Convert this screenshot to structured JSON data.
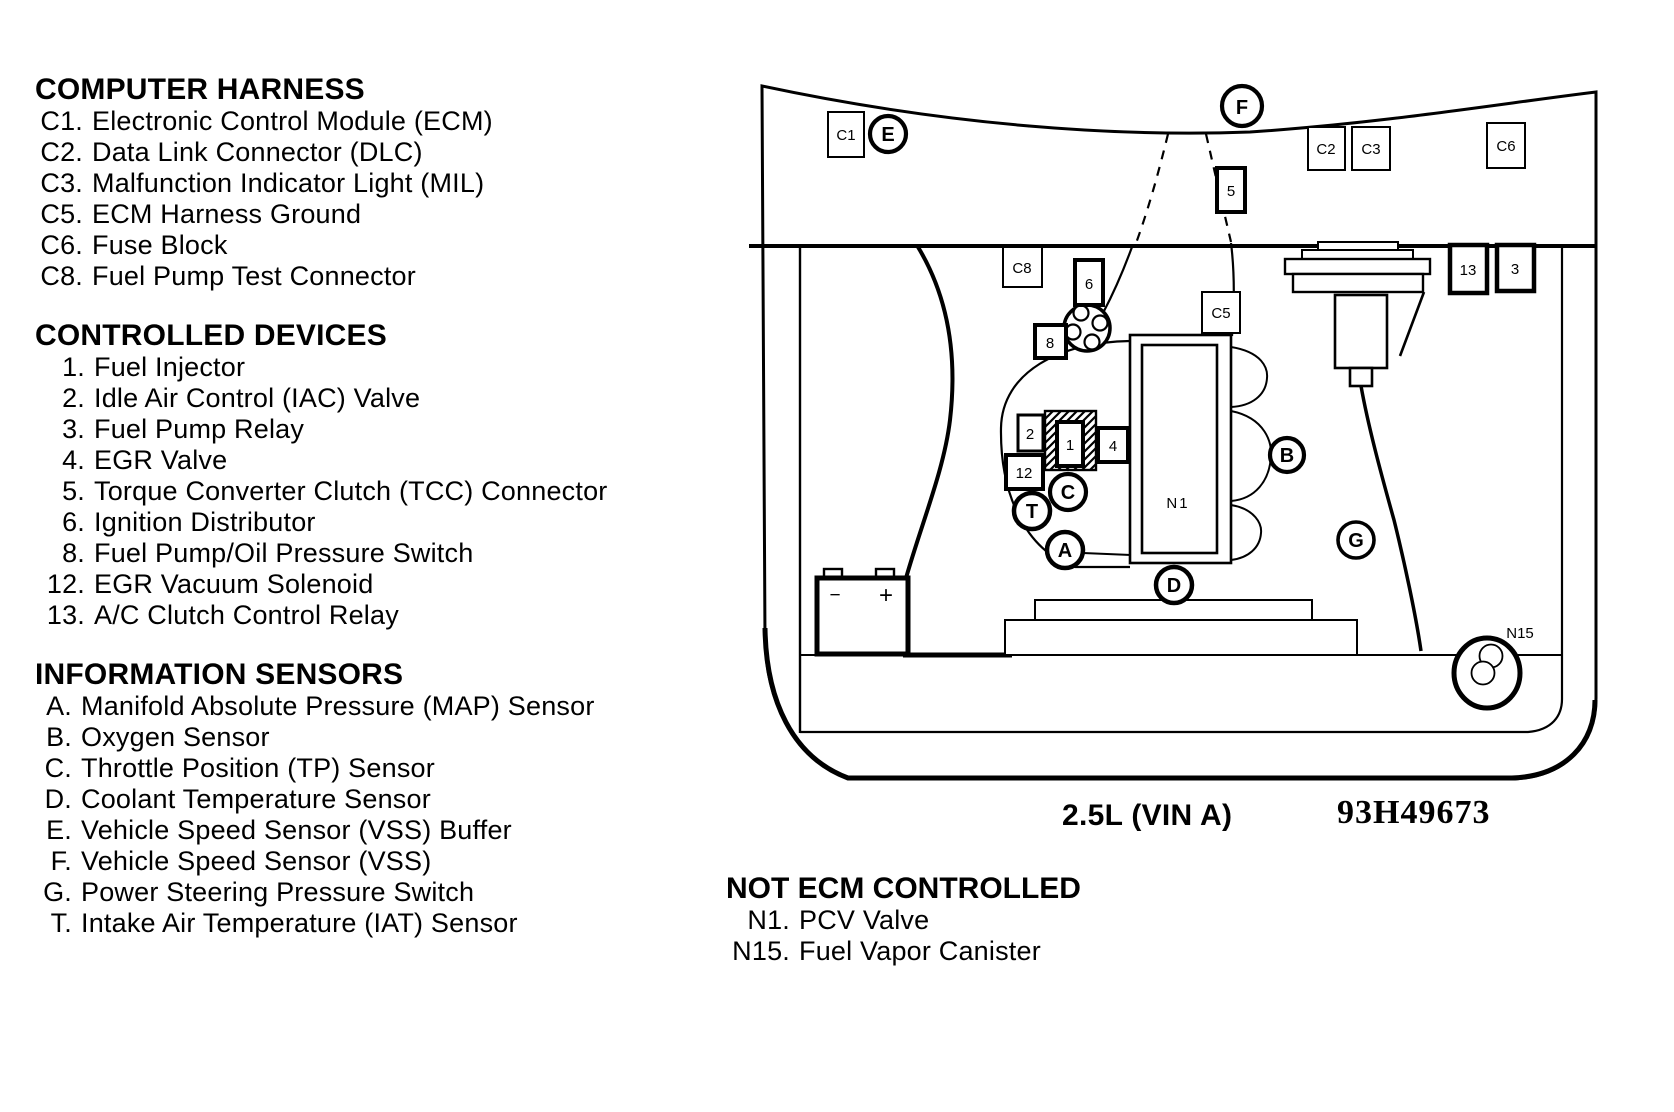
{
  "legend": {
    "computer_harness": {
      "title": "COMPUTER HARNESS",
      "items": [
        {
          "num": "C1.",
          "label": "Electronic Control Module (ECM)"
        },
        {
          "num": "C2.",
          "label": "Data Link Connector (DLC)"
        },
        {
          "num": "C3.",
          "label": "Malfunction Indicator Light (MIL)"
        },
        {
          "num": "C5.",
          "label": "ECM Harness Ground"
        },
        {
          "num": "C6.",
          "label": "Fuse Block"
        },
        {
          "num": "C8.",
          "label": "Fuel Pump Test Connector"
        }
      ]
    },
    "controlled_devices": {
      "title": "CONTROLLED DEVICES",
      "items": [
        {
          "num": "1.",
          "label": "Fuel Injector"
        },
        {
          "num": "2.",
          "label": "Idle Air Control (IAC) Valve"
        },
        {
          "num": "3.",
          "label": "Fuel Pump Relay"
        },
        {
          "num": "4.",
          "label": "EGR Valve"
        },
        {
          "num": "5.",
          "label": "Torque Converter Clutch (TCC) Connector"
        },
        {
          "num": "6.",
          "label": "Ignition Distributor"
        },
        {
          "num": "8.",
          "label": "Fuel Pump/Oil Pressure Switch"
        },
        {
          "num": "12.",
          "label": "EGR Vacuum Solenoid"
        },
        {
          "num": "13.",
          "label": "A/C Clutch Control Relay"
        }
      ]
    },
    "information_sensors": {
      "title": "INFORMATION SENSORS",
      "items": [
        {
          "num": "A.",
          "label": "Manifold Absolute Pressure (MAP) Sensor"
        },
        {
          "num": "B.",
          "label": "Oxygen Sensor"
        },
        {
          "num": "C.",
          "label": "Throttle Position (TP) Sensor"
        },
        {
          "num": "D.",
          "label": "Coolant Temperature Sensor"
        },
        {
          "num": "E.",
          "label": "Vehicle Speed Sensor (VSS) Buffer"
        },
        {
          "num": "F.",
          "label": "Vehicle Speed Sensor (VSS)"
        },
        {
          "num": "G.",
          "label": "Power Steering Pressure Switch"
        },
        {
          "num": "T.",
          "label": "Intake Air Temperature (IAT) Sensor"
        }
      ]
    },
    "not_ecm_controlled": {
      "title": "NOT ECM CONTROLLED",
      "items": [
        {
          "num": "N1.",
          "label": "PCV Valve"
        },
        {
          "num": "N15.",
          "label": "Fuel Vapor Canister"
        }
      ]
    }
  },
  "diagram": {
    "engine_label": "2.5L (VIN A)",
    "part_code": "93H49673",
    "callouts": {
      "c1": "C1",
      "e": "E",
      "f": "F",
      "c2": "C2",
      "c3": "C3",
      "c6": "C6",
      "v5": "5",
      "c8": "C8",
      "v6": "6",
      "v8": "8",
      "c5": "C5",
      "v2": "2",
      "v1": "1",
      "v4": "4",
      "v12": "12",
      "t": "T",
      "c": "C",
      "a": "A",
      "b": "B",
      "d": "D",
      "g": "G",
      "n1": "N1",
      "v13": "13",
      "v3": "3",
      "n15": "N15"
    },
    "battery": {
      "minus": "−",
      "plus": "+"
    }
  },
  "colors": {
    "ink": "#000000",
    "paper": "#ffffff"
  }
}
